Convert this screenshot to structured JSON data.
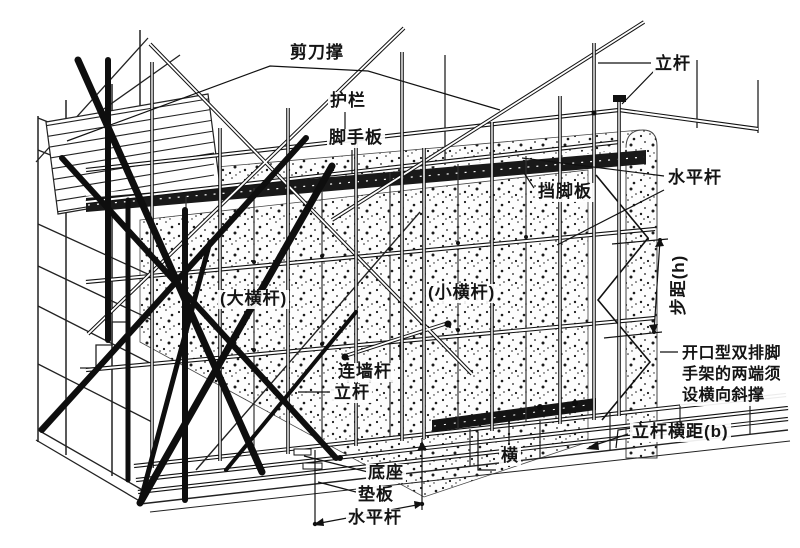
{
  "canvas": {
    "width": 800,
    "height": 548,
    "background": "#ffffff",
    "ink": "#111111",
    "wall_dot_color": "#1b1b1b"
  },
  "labels": {
    "scissor_brace": "剪刀撑",
    "upright_top": "立杆",
    "guardrail": "护栏",
    "scaffold_board": "脚手板",
    "horizontal_bar_right": "水平杆",
    "toe_board": "挡脚板",
    "step_height": "步距(h)",
    "main_ledger": "(大横杆)",
    "transverse_ledger": "(小横杆)",
    "wall_tie": "连墙杆",
    "upright_mid": "立杆",
    "open_end_note": "开口型双排脚手架的两端须设横向斜撑",
    "upright_row_spacing": "立杆横距(b)",
    "transverse_short": "横",
    "base_plate": "底座",
    "pad_board": "垫板",
    "horizontal_bar_bottom": "水平杆"
  }
}
